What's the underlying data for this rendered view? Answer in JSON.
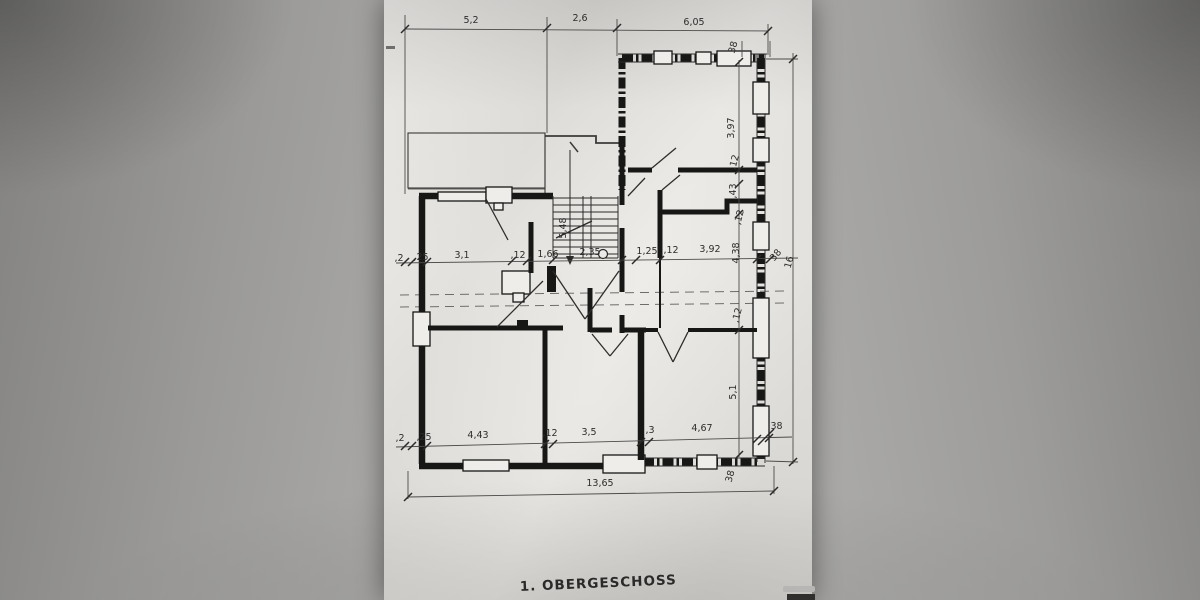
{
  "drawing": {
    "title": "1. OBERGESCHOSS",
    "kind": "scanned architectural floor plan",
    "colors": {
      "paper": "#e9e7e3",
      "surround": "#9b9a98",
      "wall_line": "#171716",
      "dim_line": "#4c4b4a"
    },
    "dims": {
      "top": [
        "5,2",
        "2,6",
        "6,05"
      ],
      "middle": [
        ",2",
        ",25",
        "3,1",
        ",12",
        "1,66",
        "2,35",
        "1,25",
        ",12",
        "3,92",
        "38",
        "16"
      ],
      "lower": [
        ",2",
        ",25",
        "4,43",
        ",12",
        "3,5",
        ",3",
        "4,67",
        ",38"
      ],
      "right": [
        "38",
        "3,97",
        ",12",
        ",43",
        ",12",
        "4,38",
        ",12",
        "5,1",
        "38"
      ],
      "stair_run": "5,48",
      "total_width": "13,65"
    }
  }
}
